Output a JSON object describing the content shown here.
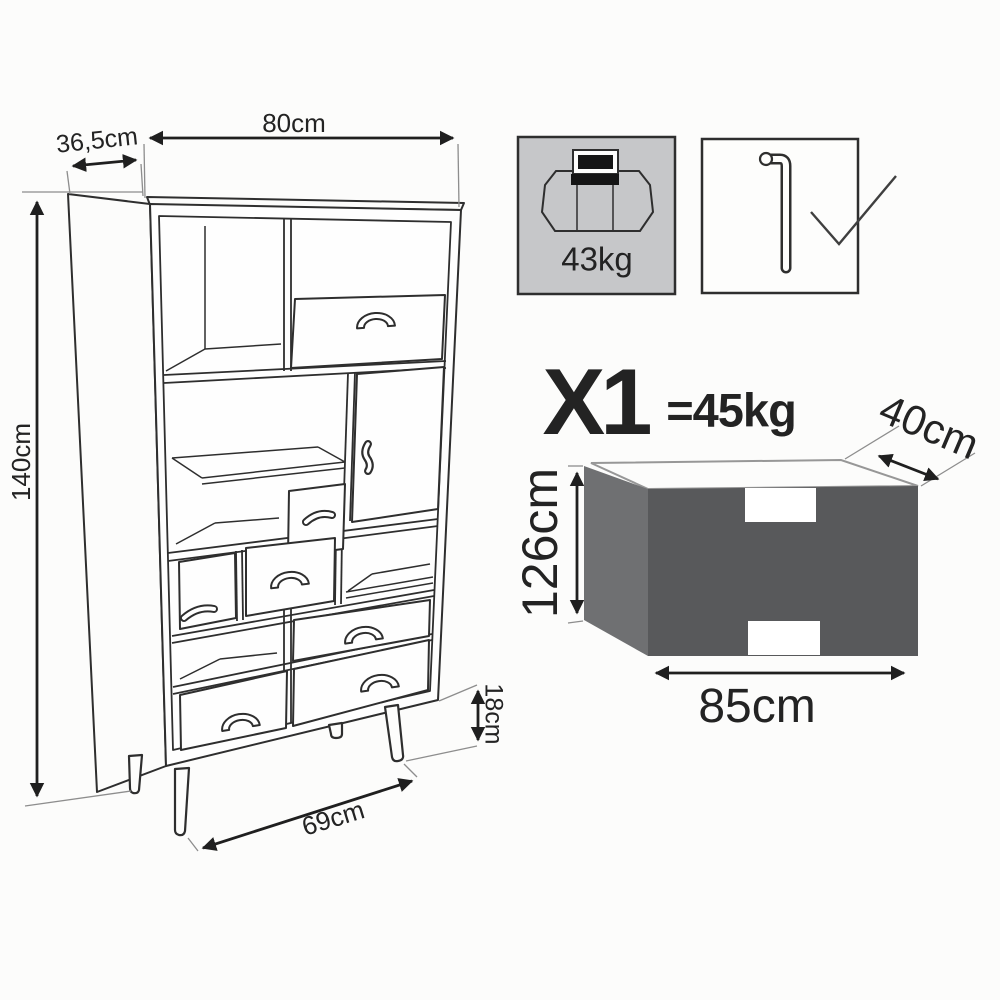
{
  "cabinet": {
    "width_label": "80cm",
    "depth_label": "36,5cm",
    "height_label": "140cm",
    "leg_height_label": "18cm",
    "base_width_label": "69cm"
  },
  "max_load_box": {
    "value": "43kg",
    "icon": "max-load-scale-icon",
    "fill_color": "#c6c7c9"
  },
  "tools_box": {
    "icons": [
      "allen-key-icon",
      "checkmark-icon"
    ]
  },
  "package": {
    "quantity_label": "X1",
    "weight_label": "=45kg",
    "depth_label": "40cm",
    "height_label": "126cm",
    "width_label": "85cm",
    "front_color": "#58595b",
    "side_color": "#6f7072"
  },
  "colors": {
    "line": "#2e2e2e",
    "arrow": "#1f1f1f",
    "leader": "#8d8d8d",
    "background": "#fcfcfb"
  }
}
